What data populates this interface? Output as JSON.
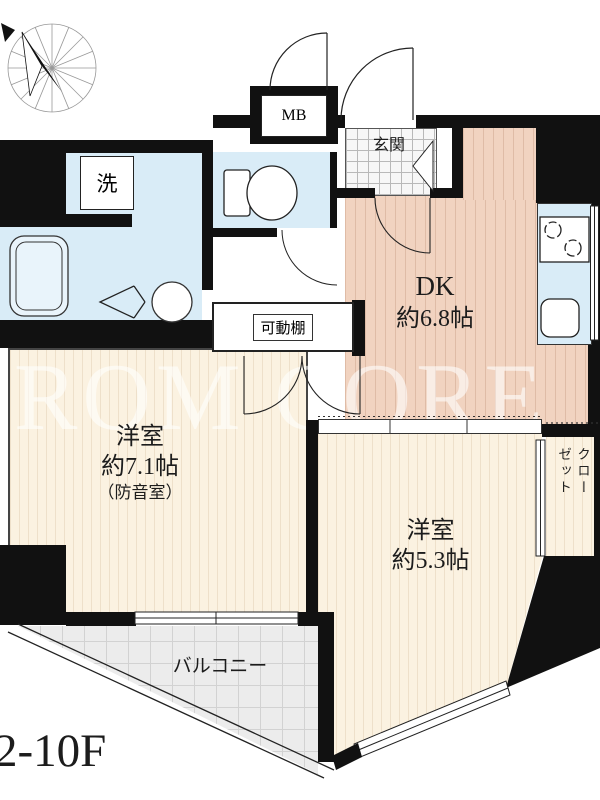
{
  "watermark": "ROM CORE",
  "floor_label": "2-10F",
  "colors": {
    "wall": "#111111",
    "wet_room": "#d9ecf7",
    "dk_floor": "#f1d3c0",
    "bedroom_floor": "#fbf2e1",
    "balcony_floor": "#ececec"
  },
  "rooms": {
    "dk": {
      "name": "DK",
      "size": "約6.8帖"
    },
    "bedroom_main": {
      "name": "洋室",
      "size": "約7.1帖",
      "note": "（防音室）"
    },
    "bedroom_second": {
      "name": "洋室",
      "size": "約5.3帖"
    },
    "balcony": {
      "name": "バルコニー"
    },
    "entrance": {
      "name": "玄関"
    },
    "closet": {
      "line1": "クロー",
      "line2": "ゼット"
    }
  },
  "labels": {
    "meter_box": "MB",
    "laundry": "洗",
    "movable_shelf": "可動棚"
  }
}
